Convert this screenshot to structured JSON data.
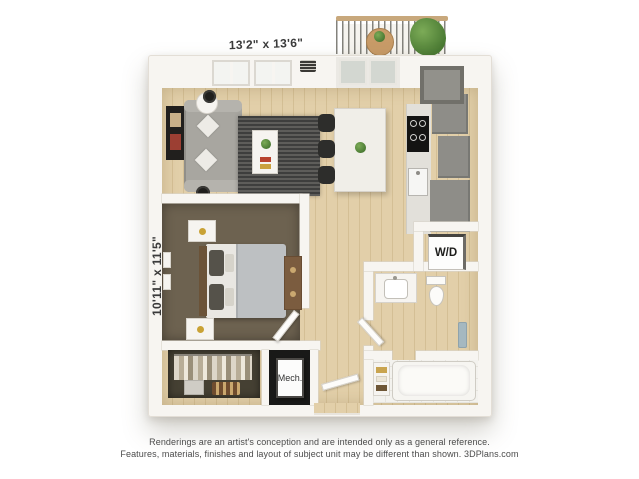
{
  "floor_plan": {
    "living_area_dimensions": "13'2\" x 13'6\"",
    "bedroom_dimensions": "10'11\" x 11'5\"",
    "washer_dryer_label": "W/D",
    "mechanical_closet_label": "Mech."
  },
  "footer": {
    "disclaimer_line1": "Renderings are an artist's conception and are intended only as a general reference.",
    "disclaimer_line2": "Features, materials, finishes and layout of subject unit may be different than shown. 3DPlans.com"
  },
  "colors": {
    "wall": "#f7f5f1",
    "wood_floor": "#e0cda6",
    "bedroom_carpet": "#6d6250",
    "closet_interior": "#454033",
    "mech_floor": "#191918",
    "kitchen_cabinets": "#8e8d88",
    "sofa": "#a8a6a0",
    "rug": "#464645",
    "bed_duvet": "#bdc0c2",
    "dresser_wood": "#7b5c3f",
    "balcony_rail_wood": "#c8a87c",
    "plant_green": "#4a8a38",
    "towel_blue": "#a5b8c0",
    "label_text": "#3a3a3a",
    "footer_text": "#4c4c4c"
  }
}
